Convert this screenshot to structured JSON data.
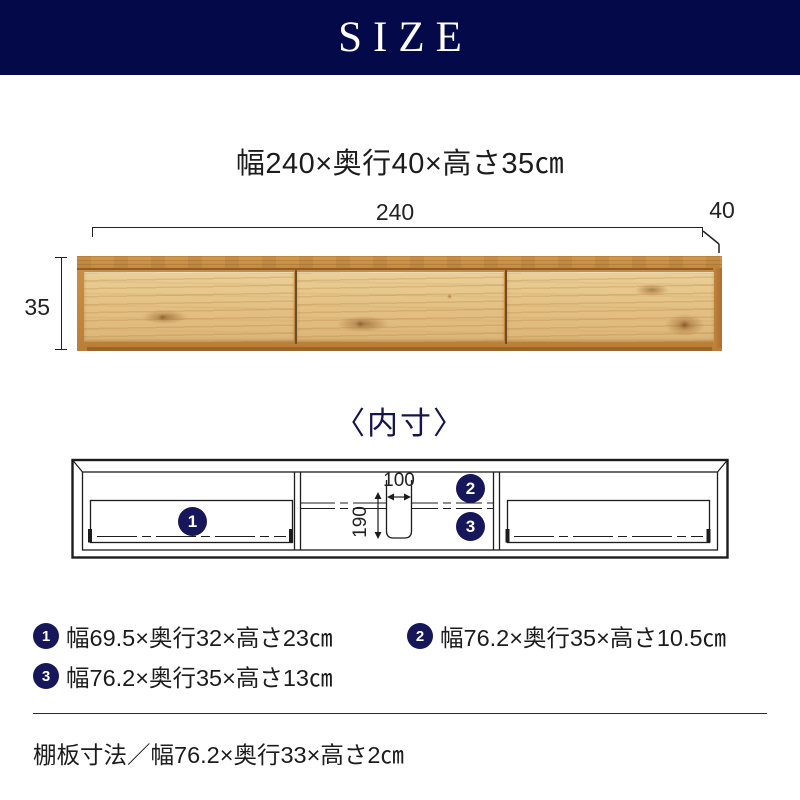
{
  "header": {
    "title": "SIZE"
  },
  "summary": {
    "dimensions": "幅240×奥行40×高さ35㎝"
  },
  "outer_diagram": {
    "width_label": "240",
    "depth_label": "40",
    "height_label": "35"
  },
  "inner_diagram": {
    "title": "〈内寸〉",
    "marker_1": "1",
    "marker_2": "2",
    "marker_3": "3",
    "opening_width_label": "100",
    "opening_height_label": "190"
  },
  "legend": {
    "items": [
      {
        "marker": "1",
        "text": "幅69.5×奥行32×高さ23㎝"
      },
      {
        "marker": "2",
        "text": "幅76.2×奥行35×高さ10.5㎝"
      },
      {
        "marker": "3",
        "text": "幅76.2×奥行35×高さ13㎝"
      }
    ]
  },
  "footer": {
    "shelf_note": "棚板寸法／幅76.2×奥行33×高さ2㎝"
  },
  "colors": {
    "header_navy": "#04094a",
    "marker_navy": "#16165a",
    "wood_front": "#e3bf83",
    "wood_frame": "#c2863d",
    "line_color": "#1c1c1c"
  }
}
